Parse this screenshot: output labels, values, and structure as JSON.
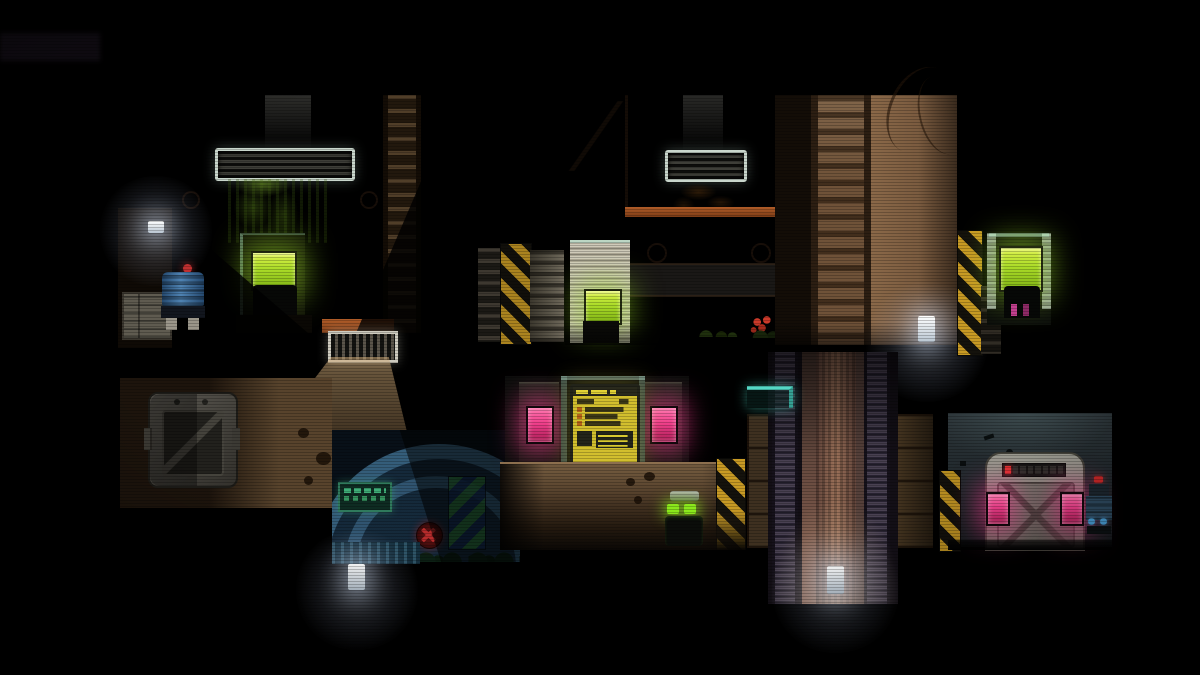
{
  "app": {
    "name": "stealth-puzzle-platformer",
    "visible_text": [],
    "note": "no legible text rendered; terminal screens show illegible pixel glyphs"
  },
  "palette": {
    "bg": "#000000",
    "wall_tan": "#9a7452",
    "wall_tan_deep": "#7e5c40",
    "wall_orange_lip": "#a85827",
    "hazard_yellow": "#c89a24",
    "screen_green": "#aadb28",
    "screen_yellow": "#d2bf2e",
    "pink_glow": "#ef3f8b",
    "dome_blue": "#4b8ab4",
    "teal_glow": "#55d8c6",
    "lamp_white": "#e8f0ff",
    "moss_green": "#54701e",
    "mine_red": "#c03030",
    "eye_green": "#8ae81c",
    "robot_blue": "#3f6f9f",
    "door_grey": "#77776d",
    "shaft_pink": "#99705a"
  },
  "scene": {
    "rooms": [
      {
        "name": "room-upper-left",
        "contents": [
          "ceiling-vent",
          "moss-growth",
          "green-terminal-screen",
          "terminal-silhouette",
          "ladder-column",
          "shadow-wedges"
        ]
      },
      {
        "name": "room-upper-middle",
        "contents": [
          "ceiling-vent",
          "dirt-patch",
          "white-alcove",
          "green-door-screen",
          "ladder-column",
          "red-flowers",
          "wall-lamp"
        ]
      },
      {
        "name": "nook-upper-right",
        "contents": [
          "hazard-column",
          "green-terminal-screen",
          "robot-silhouette"
        ]
      },
      {
        "name": "room-terminal-middle",
        "contents": [
          "yellow-data-screen",
          "pink-indicator-left",
          "pink-indicator-right",
          "pedestal-steps"
        ]
      },
      {
        "name": "room-lower-left",
        "contents": [
          "metal-airlock-door",
          "light-cone",
          "moss-spots"
        ]
      },
      {
        "name": "room-blue-dome",
        "contents": [
          "dome-arches",
          "green-text-sign",
          "red-mine",
          "green-blue-hazard",
          "grass-silhouette",
          "floor-lamp"
        ]
      },
      {
        "name": "corridor-lower-middle",
        "contents": [
          "player-clone-robot",
          "hazard-column"
        ]
      },
      {
        "name": "shaft-right",
        "contents": [
          "chain-columns",
          "teal-ledge",
          "floor-lamp",
          "panel-walls"
        ]
      },
      {
        "name": "room-lower-right",
        "contents": [
          "cross-braced-door",
          "indicator-strip",
          "pink-door-lights",
          "sentry-robot",
          "hazard-column"
        ]
      }
    ],
    "characters": [
      {
        "name": "player-clone-robot",
        "eye_color": "#8ae81c",
        "location": "corridor-lower-middle"
      },
      {
        "name": "barrel-robot",
        "body_color": "#3f6f9f",
        "top_light": "#c02828",
        "location": "left-of-room-upper-left"
      },
      {
        "name": "sentry-robot",
        "body_color": "#2e4a60",
        "top_light": "#c82828",
        "location": "room-lower-right"
      },
      {
        "name": "terminal-robot-silhouette",
        "accent_color": "#d04898",
        "location": "nook-upper-right"
      }
    ],
    "lights": [
      {
        "name": "wall-lamp-left",
        "color": "#e8f0ff"
      },
      {
        "name": "wall-lamp-middle-room",
        "color": "#e8f0ff"
      },
      {
        "name": "floor-lamp-dome",
        "color": "#e8f0ff"
      },
      {
        "name": "floor-lamp-shaft",
        "color": "#e8f0ff"
      },
      {
        "name": "pink-door-lights",
        "color": "#ef3f8b"
      },
      {
        "name": "green-screens",
        "color": "#aadb28"
      },
      {
        "name": "yellow-screen",
        "color": "#d2bf2e"
      }
    ]
  }
}
